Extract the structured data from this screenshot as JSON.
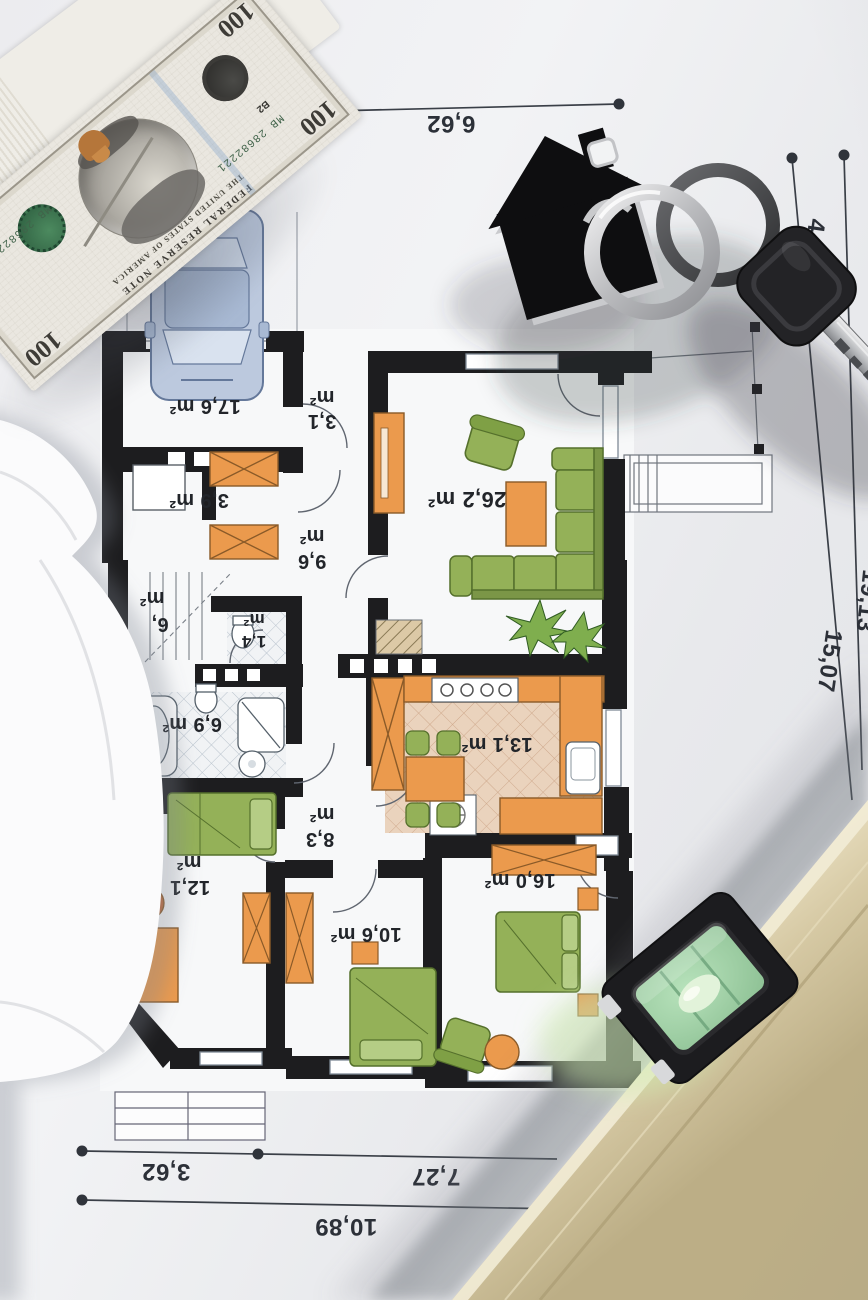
{
  "palette": {
    "paper": "#ebecee",
    "wall_black": "#1d1d1f",
    "furniture_orange": "#eb9a4d",
    "furniture_green": "#94b158",
    "car_blue": "#bcc9de",
    "kitchen_floor": "#ead3bd",
    "level_tan": "#d6c9a4",
    "vial_green": "#9fd0a6",
    "dimension_ink": "#2c3038"
  },
  "floor_plan": {
    "rooms": [
      {
        "id": "garage",
        "value": "17,6",
        "unit": "m²"
      },
      {
        "id": "entry",
        "value": "3,1",
        "unit": "m²"
      },
      {
        "id": "storage",
        "value": "3,9",
        "unit": "m²"
      },
      {
        "id": "hallway",
        "value": "9,6",
        "unit": "m²"
      },
      {
        "id": "living-room",
        "value": "26,2",
        "unit": "m²"
      },
      {
        "id": "stair-room",
        "value": "6,",
        "unit": "m²"
      },
      {
        "id": "wc",
        "value": "1,4",
        "unit": "m²"
      },
      {
        "id": "bathroom",
        "value": "6,9",
        "unit": "m²"
      },
      {
        "id": "kitchen",
        "value": "13,1",
        "unit": "m²"
      },
      {
        "id": "hall",
        "value": "8,3",
        "unit": "m²"
      },
      {
        "id": "bedroom-1",
        "value": "12,1",
        "unit": "m²"
      },
      {
        "id": "bedroom-2",
        "value": "10,6",
        "unit": "m²"
      },
      {
        "id": "bedroom-3",
        "value": "16,0",
        "unit": "m²"
      }
    ],
    "dimensions": {
      "top": "6,62",
      "right_upper": "4,06",
      "right_lower": "15,07",
      "right_total": "19,13",
      "bottom_left": "3,62",
      "bottom_right": "7,27",
      "bottom_total": "10,89"
    }
  },
  "banknote": {
    "denomination": "100",
    "serial_number": "MB 28682221",
    "plate_letter": "B2",
    "note_type": "FEDERAL RESERVE NOTE",
    "country": "THE UNITED STATES OF AMERICA"
  }
}
